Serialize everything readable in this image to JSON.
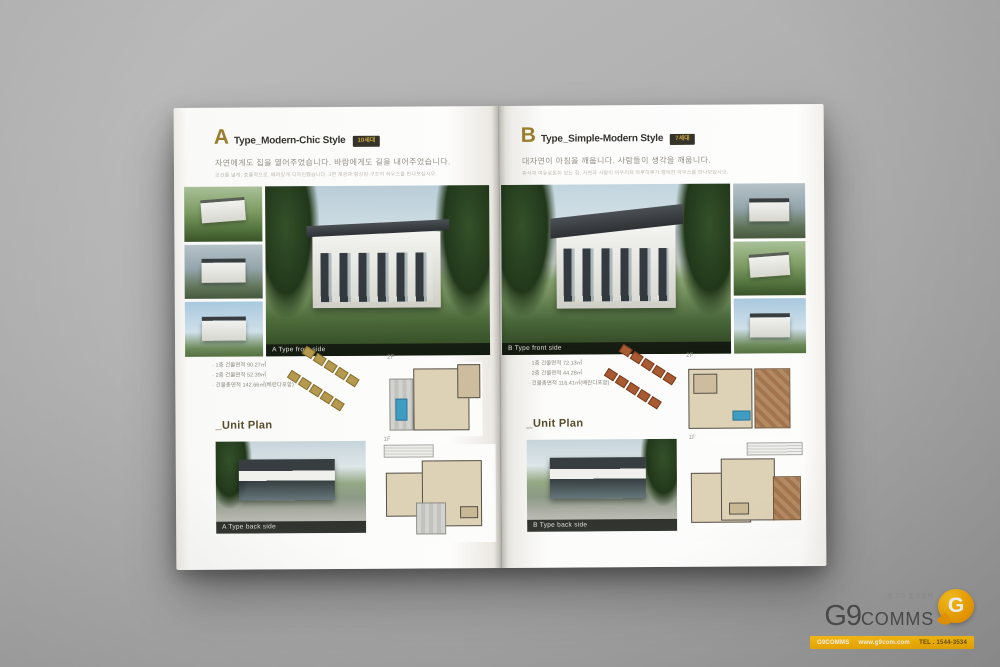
{
  "pages": {
    "left": {
      "letter": "A",
      "title": "Type_Modern-Chic Style",
      "badge": "10세대",
      "headline": "자연에게도 집을 열어주었습니다. 바람에게도 길을 내어주었습니다.",
      "subline": "공간을 넓게, 효율적으로, 배려있게 디자인했습니다. 3면 채광과 향상된 구조의 하우스를 만나보십시오.",
      "front_caption": "A Type front side",
      "specs": [
        "1층 건물면적 90.27㎡",
        "2층 건물면적 52.39㎡",
        "건물총면적 142.66㎡(베란다포함)"
      ],
      "floor2_label": "2F",
      "unit_plan": "_Unit Plan",
      "back_caption": "A Type back side",
      "floor1_label": "1F"
    },
    "right": {
      "letter": "B",
      "title": "Type_Simple-Modern Style",
      "badge": "7세대",
      "headline": "대자연이 아침을 깨웁니다. 사람들이 생각을 깨웁니다.",
      "subline": "휴식과 여유로움이 있는 집, 자연과 사람이 어우러져 하루하루가 행복한 하우스를 만나보십시오.",
      "front_caption": "B Type front side",
      "specs": [
        "1층 건물면적 72.13㎡",
        "2층 건물면적 44.28㎡",
        "건물총면적 116.41㎡(베란다포함)"
      ],
      "floor2_label": "2F",
      "unit_plan": "_Unit Plan",
      "back_caption": "B Type back side",
      "floor1_label": "1F"
    }
  },
  "logo": {
    "tagline": "광고가 필요할땐",
    "g9": "G9",
    "comms": "COMMS",
    "bubble": "G",
    "bar": {
      "brand": "G9COMMS",
      "web": "www.g9com.com",
      "tel": "TEL . 1544-3534"
    }
  },
  "colors": {
    "accent_gold": "#9a7c2d",
    "badge_bg": "#36342a",
    "badge_text": "#c9a53e",
    "logo_yellow": "#f3ad00",
    "logo_orange": "#ef8e00"
  }
}
